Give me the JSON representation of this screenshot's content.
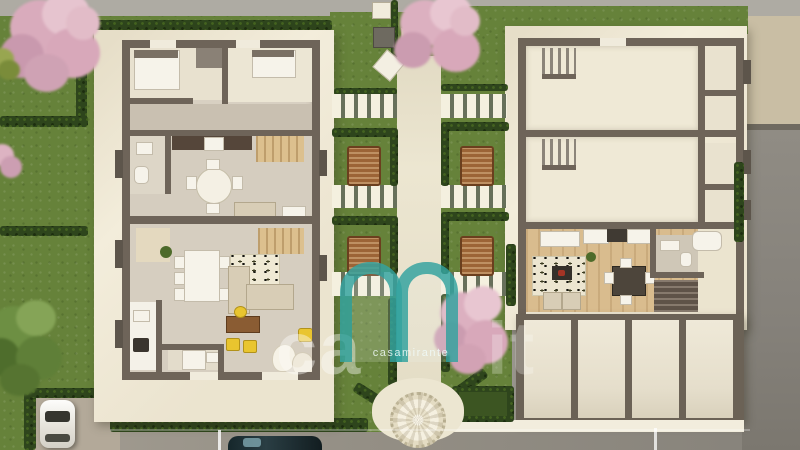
{
  "watermark": {
    "left": "ca",
    "right": "it",
    "brand": "casamirante",
    "logo_icon": "m-arch-logo",
    "teal": "#2ca09d"
  },
  "palette": {
    "lawn": "#66823a",
    "hedge": "#2e451c",
    "terrace": "#f3eddb",
    "wall": "#6e6459",
    "wood_floor": "#d9bc8e",
    "concrete": "#8b877f",
    "asphalt": "#96918a",
    "blossom": "#dcaebb",
    "rattan": "#9c6436",
    "accent_yellow": "#e9c52f"
  },
  "site": {
    "buildings": 2,
    "garage_bays": 4,
    "courtyard_patios": 4,
    "stair_walkways": 6,
    "cars": 2,
    "pink_trees": 4,
    "green_trees": 2
  }
}
